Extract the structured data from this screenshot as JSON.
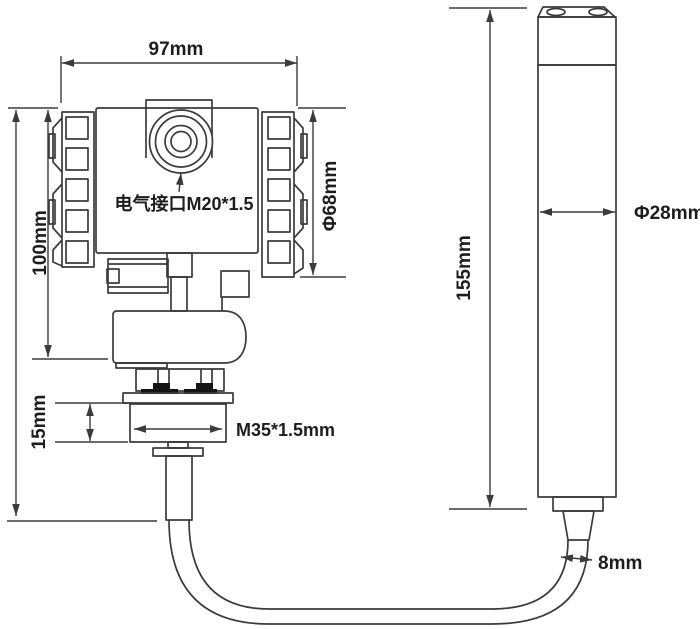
{
  "labels": {
    "head_width": "97mm",
    "head_height": "100mm",
    "head_diameter": "Φ68mm",
    "electrical_port": "电气接口M20*1.5",
    "thread_height": "15mm",
    "thread_spec": "M35*1.5mm",
    "probe_length": "155mm",
    "probe_diameter": "Φ28mm",
    "cable_diameter": "8mm"
  },
  "colors": {
    "line": "#3b3b3b",
    "text": "#1d1d1d",
    "ink": "#141414",
    "background": "#ffffff"
  }
}
